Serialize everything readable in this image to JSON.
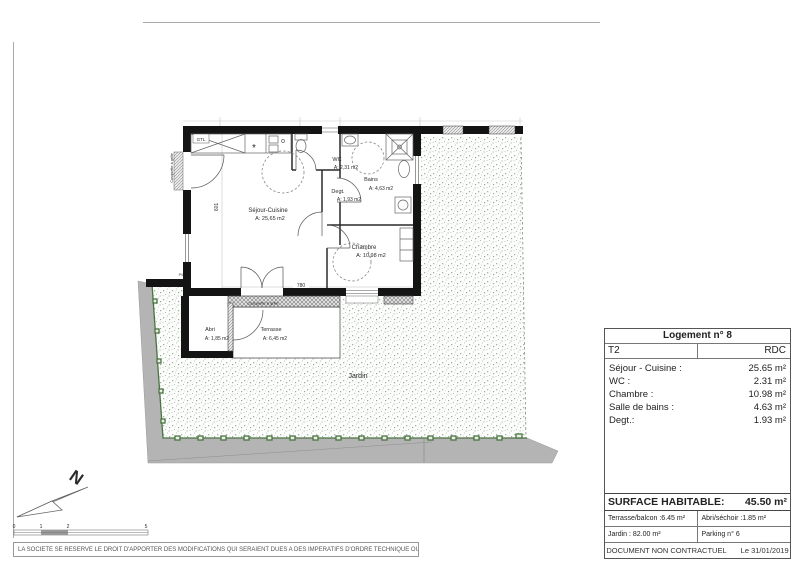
{
  "plan": {
    "rooms": {
      "sejour": {
        "name": "Séjour-Cuisine",
        "area": "A: 25,65 m2"
      },
      "wc": {
        "name": "WC",
        "area": "A: 2,31 m2"
      },
      "degt": {
        "name": "Degt.",
        "area": "A: 1,93 m2"
      },
      "bains": {
        "name": "Bains",
        "area": "A: 4,63 m2"
      },
      "chambre": {
        "name": "Chambre",
        "area": "A: 10,98 m2"
      },
      "abri": {
        "name": "Abri",
        "area": "A: 1,85 m2"
      },
      "terrasse": {
        "name": "Terrasse",
        "area": "A: 6,45 m2"
      },
      "jardin": {
        "name": "Jardin"
      }
    },
    "annotations": {
      "gtl": "GTL",
      "casquette": "Casquette à grille",
      "pv": "PV",
      "dim_width": "780",
      "dim_height": "601",
      "hob_symbol": "*"
    },
    "north_label": "N",
    "scale": {
      "marks": [
        "0",
        "1",
        "2",
        "5"
      ]
    }
  },
  "info_table": {
    "title": "Logement n° 8",
    "type": "T2",
    "floor": "RDC",
    "rows": [
      {
        "label": "Séjour - Cuisine :",
        "value": "25.65 m²"
      },
      {
        "label": "WC :",
        "value": "2.31 m²"
      },
      {
        "label": "Chambre :",
        "value": "10.98 m²"
      },
      {
        "label": "Salle de bains :",
        "value": "4.63 m²"
      },
      {
        "label": "Degt.:",
        "value": "1.93 m²"
      }
    ],
    "surface": {
      "label": "SURFACE HABITABLE:",
      "value": "45.50 m²"
    },
    "extras": [
      {
        "left": "Terrasse/balcon :6.45 m²",
        "right": "Abri/séchoir :1.85 m²"
      },
      {
        "left": "Jardin : 82.00 m²",
        "right": "Parking n° 6"
      }
    ],
    "footer": {
      "left": "DOCUMENT NON CONTRACTUEL",
      "right": "Le 31/01/2019"
    }
  },
  "disclaimer": "LA SOCIETE SE RESERVE LE DROIT D'APPORTER DES MODIFICATIONS QUI SERAIENT DUES A DES IMPERATIFS D'ORDRE TECHNIQUE OU ADMINISTRATIF",
  "colors": {
    "wall": "#141414",
    "fence_green": "#4a7341",
    "garden_dot": "#9dbb97",
    "road_gray": "#b4b4b4"
  }
}
